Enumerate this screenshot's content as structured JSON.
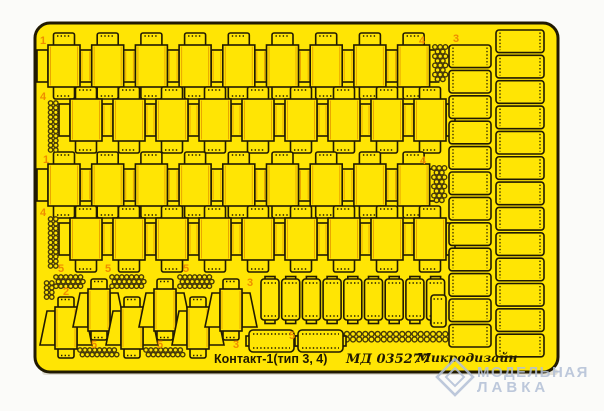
{
  "photo": {
    "background_color": "#fbfbf9",
    "sheet_color": "#ffe504",
    "line_color": "#211a02",
    "label_color": "#ef8c00",
    "fold_line_color": "#e9a700",
    "ring_color": "#473a08",
    "shadow_color": "#d9d6c8"
  },
  "labels": {
    "n1": "1",
    "n2": "2",
    "n3": "3",
    "n4": "4",
    "n5": "5"
  },
  "footer": {
    "title": "Контакт-1(тип 3, 4)",
    "code": "МД 035277",
    "brand": "Микродизайн"
  },
  "watermark": {
    "line1": "МОДЕЛЬНАЯ",
    "line2": "ЛАВКА",
    "color": "#b3c0d6"
  }
}
